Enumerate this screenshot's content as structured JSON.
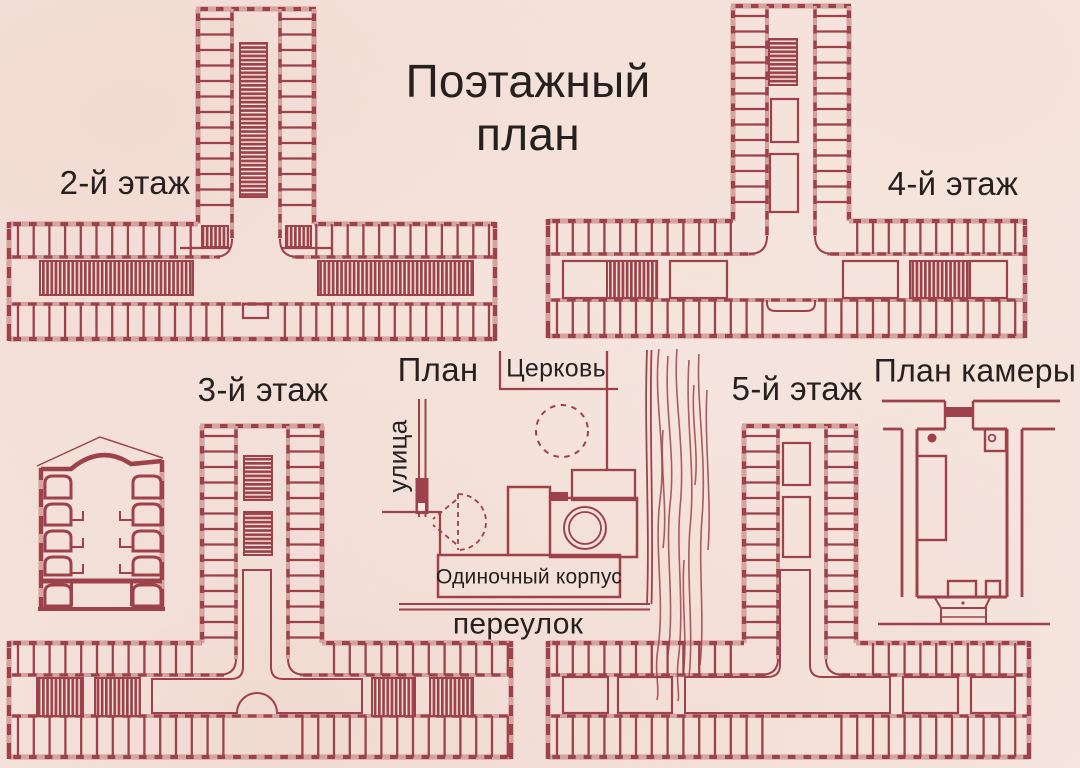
{
  "title": "Поэтажный план",
  "colors": {
    "ink": "#9d424b",
    "paper": "#f7e9e2",
    "paper_light": "#f6e4dd",
    "window": "#d5a49e",
    "text": "#26211f"
  },
  "labels": {
    "floor2": "2-й этаж",
    "floor3": "3-й этаж",
    "floor4": "4-й этаж",
    "floor5": "5-й этаж",
    "site_plan": "План",
    "church": "Церковь",
    "street": "улица",
    "lane": "переулок",
    "building": "Одиночный корпус",
    "cell_plan": "План камеры"
  }
}
